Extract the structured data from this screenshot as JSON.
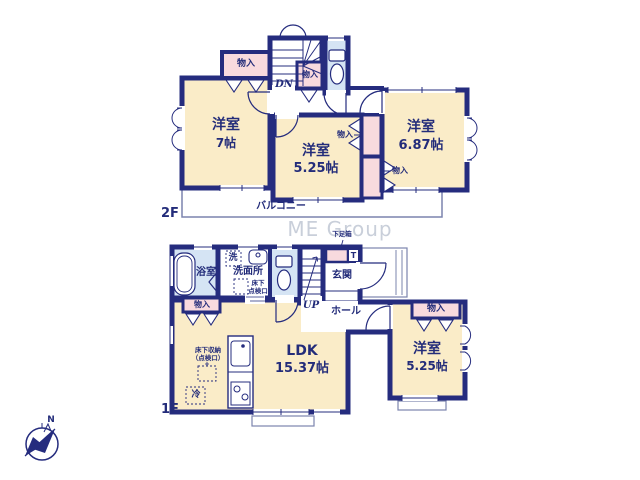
{
  "palette": {
    "wall_navy": "#252c7e",
    "room_cream": "#faecc8",
    "closet_pink": "#f8dade",
    "wet_area_blue": "#d5e4f4",
    "thin_line": "#7b84ae",
    "watermark_gray": "#c9cfda"
  },
  "watermark": "ME Group",
  "compass": {
    "north_label": "N"
  },
  "floor2": {
    "floor_label": "2F",
    "stair_label": "DN",
    "balcony_label": "バルコニー",
    "room_west_a": {
      "name": "洋室",
      "size": "7帖"
    },
    "room_west_b": {
      "name": "洋室",
      "size": "5.25帖"
    },
    "room_west_c": {
      "name": "洋室",
      "size": "6.87帖"
    },
    "closet_top_left": "物入",
    "closet_stair": "物入",
    "closet_mid_upper": "物入",
    "closet_mid_lower": "物入"
  },
  "floor1": {
    "floor_label": "1F",
    "stair_label": "UP",
    "bath_label": "浴室",
    "laundry_label": "洗",
    "washroom_label": "洗面所",
    "washroom_hatch": {
      "line1": "床下",
      "line2": "点検口"
    },
    "entrance_label": "玄関",
    "shoe_cabinet_label": "下足箱",
    "toilet_mark": "T",
    "hall_label": "ホール",
    "ldk": {
      "name": "LDK",
      "size": "15.37帖"
    },
    "room_west": {
      "name": "洋室",
      "size": "5.25帖"
    },
    "closet_left": "物入",
    "closet_right": "物入",
    "floor_storage": {
      "line1": "床下収納",
      "line2": "（点検口）"
    },
    "fridge_label": "冷"
  }
}
